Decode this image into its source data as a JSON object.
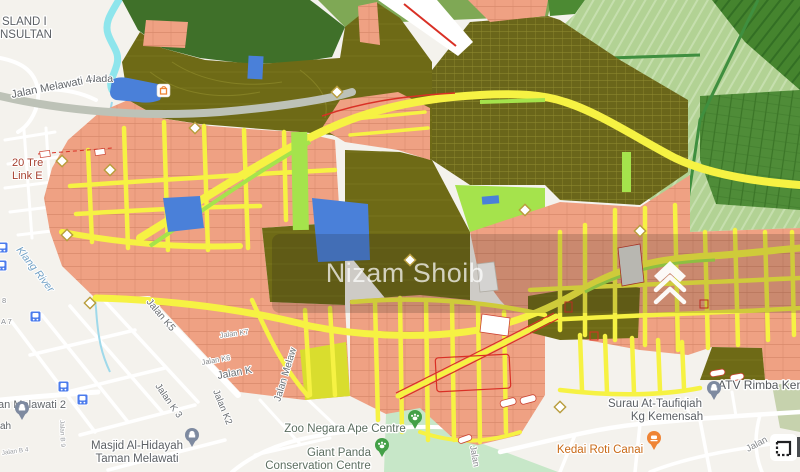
{
  "watermark": {
    "text": "Nizam Shoib"
  },
  "labels": {
    "island_line1": "SLAND I",
    "island_line2": "NSULTAN",
    "nada": "Nada",
    "jalan_melawati_4": "Jalan Melawati 4",
    "twenty_trees_line1": "20 Tre",
    "twenty_trees_line2": "Link E",
    "klang_river": "Klang River",
    "b8": "8",
    "a7": "A 7",
    "jalan_k5": "Jalan K5",
    "jalan_k7": "Jalan K7",
    "jalan_k6": "Jalan K6",
    "jalan_k": "Jalan K",
    "jalan_k3": "Jalan K 3",
    "jalan_k2": "Jalan K2",
    "jalan_melaw": "Jalan Melaw",
    "jalan_melawati_2": "Jalan Melawati 2",
    "jalan_b9": "Jalan B 9",
    "jalan_b4": "Jalan B 4",
    "masjid_partial": "ah",
    "masjid_line1": "Masjid Al-Hidayah",
    "masjid_line2": "Taman Melawati",
    "zoo_ape": "Zoo Negara Ape Centre",
    "giant_panda_line1": "Giant Panda",
    "giant_panda_line2": "Conservation Centre",
    "kedai_roti": "Kedai Roti Canai",
    "surau_line1": "Surau At-Taufiqiah",
    "surau_line2": "Kg Kemensah",
    "atv": "ATV Rimba Kem",
    "jalan_zoo": "Jalan",
    "jalan_kemensah": "Jalan"
  },
  "icons": {
    "bus": "bus-stop-icon",
    "mosque": "mosque-pin-icon",
    "paw": "zoo-paw-pin-icon",
    "food": "restaurant-pin-icon",
    "shopping": "shopping-icon",
    "diamond": "school-diamond-marker",
    "chevrons": "propertyguru-chevrons-logo",
    "frame": "map-control-frame-icon"
  },
  "colors": {
    "base": "#f4f2ed",
    "road_white": "#ffffff",
    "road_gray": "#bdc2b7",
    "salmon": "#efa183",
    "yellow_road": "#f6f243",
    "green_strip": "#a5e34c",
    "chartreuse_block": "#d9dd2e",
    "olive": "#6e6a16",
    "forest": "#3f7029",
    "plantation": "#b2d294",
    "plantation_dark": "#4f8c38",
    "mint_zoo": "#c7e7c8",
    "blue_parcel": "#4a80d9",
    "river": "#8ee5ec",
    "red_line": "#d93025",
    "label_gray": "#5d6166",
    "water_label": "#6f9fc4",
    "poi_orange": "#c96a17",
    "poi_red": "#a6402f",
    "band_overlay": "rgba(35,28,22,0.18)"
  }
}
